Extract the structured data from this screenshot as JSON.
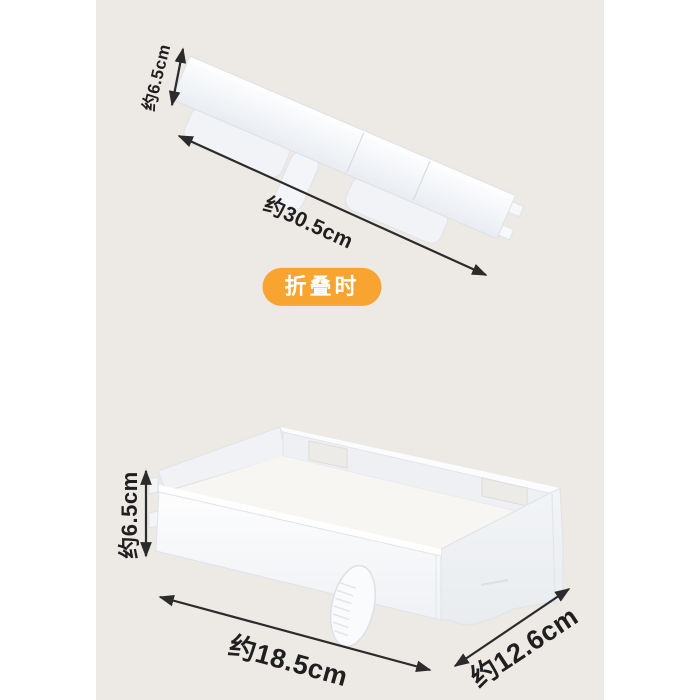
{
  "colors": {
    "page_white": "#FFFFFF",
    "canvas_beige": "#EDE9E4",
    "badge_orange": "#F7A431",
    "badge_text": "#FFFFFF",
    "dimension_text": "#1F1F1F",
    "arrow": "#2B2B2B",
    "product_white": "#FBFCFD",
    "product_shade": "#E9EDF2",
    "product_outline": "#DDE1E7"
  },
  "folded_view": {
    "badge_label": "折叠时",
    "height": {
      "label": "约6.5cm",
      "value_cm": 6.5
    },
    "length": {
      "label": "约30.5cm",
      "value_cm": 30.5
    }
  },
  "unfolded_view": {
    "height": {
      "label": "约6.5cm",
      "value_cm": 6.5
    },
    "length": {
      "label": "约18.5cm",
      "value_cm": 18.5
    },
    "depth": {
      "label": "约12.6cm",
      "value_cm": 12.6
    }
  }
}
